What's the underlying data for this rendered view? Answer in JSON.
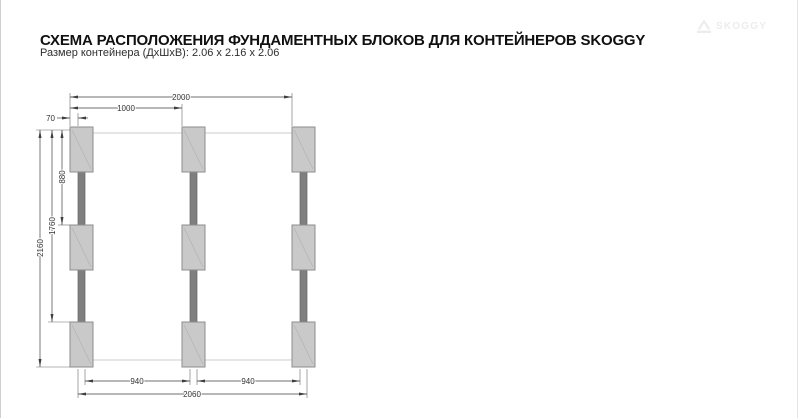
{
  "header": {
    "title": "СХЕМА РАСПОЛОЖЕНИЯ ФУНДАМЕНТНЫХ БЛОКОВ ДЛЯ КОНТЕЙНЕРОВ SKOGGY",
    "subtitle": "Размер контейнера (ДхШхВ): 2.06 х 2.16 х 2.06"
  },
  "logo": {
    "brand": "SKOGGY"
  },
  "diagram": {
    "description": "Plan view of 9 foundation blocks in 3 columns joined by beams",
    "units": "mm",
    "layout": {
      "columns": 3,
      "blocks_per_column": 3
    },
    "dimensions": {
      "top_total": "2000",
      "top_center_spacing": "1000",
      "block_edge_offset": "70",
      "height_total": "2160",
      "height_to_third_row": "1760",
      "height_to_second_row": "880",
      "bottom_gap_left": "940",
      "bottom_gap_right": "940",
      "bottom_total": "2060"
    },
    "colors": {
      "block_fill": "#c9c9c9",
      "block_border": "#8d8d8d",
      "beam_fill": "#7f7f7f",
      "dimension_line": "#3f3f3f"
    }
  }
}
